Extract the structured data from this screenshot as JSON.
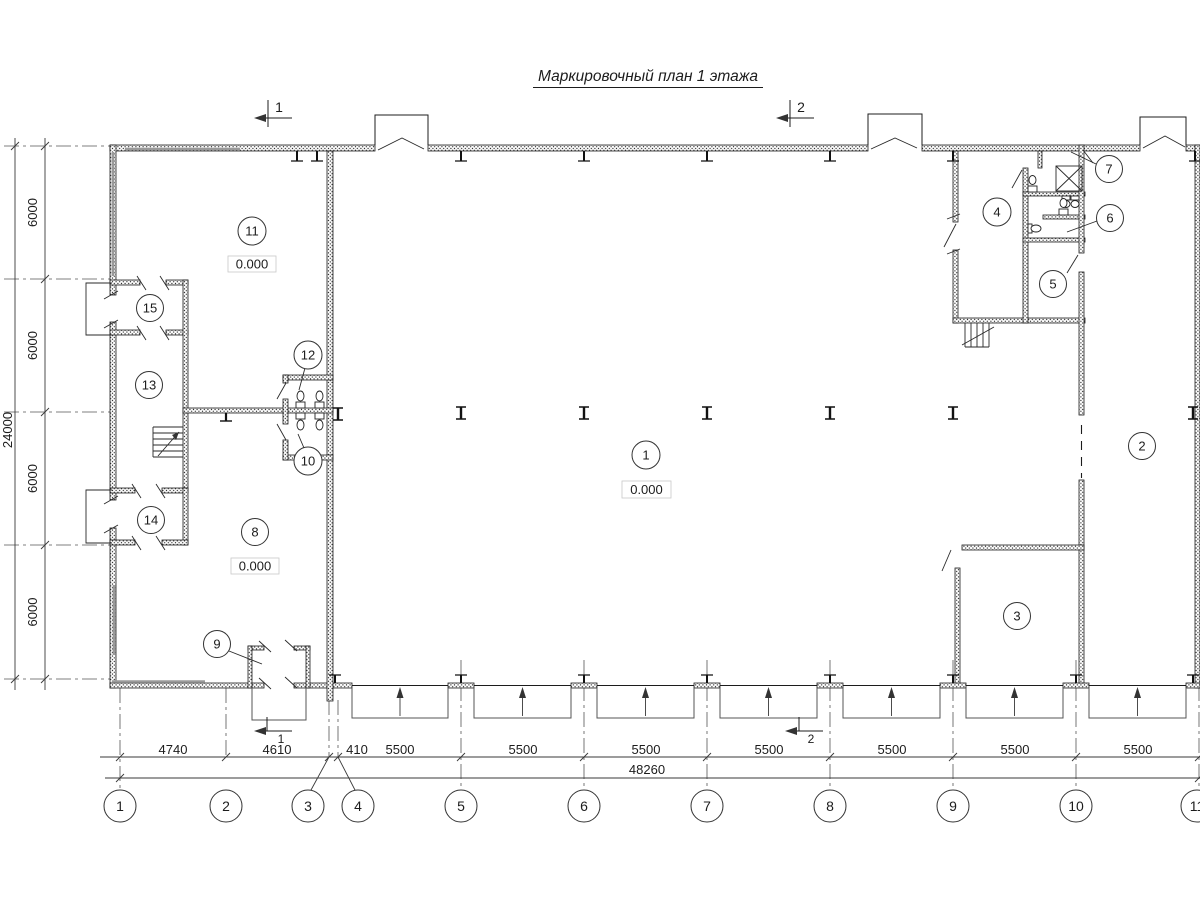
{
  "title": "Маркировочный план 1 этажа",
  "rooms": {
    "r1": "1",
    "r2": "2",
    "r3": "3",
    "r4": "4",
    "r5": "5",
    "r6": "6",
    "r7": "7",
    "r8": "8",
    "r9": "9",
    "r10": "10",
    "r11": "11",
    "r12": "12",
    "r13": "13",
    "r14": "14",
    "r15": "15"
  },
  "elevations": {
    "hall": "0.000",
    "room11": "0.000",
    "room8": "0.000"
  },
  "sections": {
    "s1": "1",
    "s2": "2"
  },
  "axes_bottom": [
    "1",
    "2",
    "3",
    "4",
    "5",
    "6",
    "7",
    "8",
    "9",
    "10",
    "11"
  ],
  "dims": {
    "bottom": [
      "4740",
      "4610",
      "410",
      "5500",
      "5500",
      "5500",
      "5500",
      "5500",
      "5500",
      "5500"
    ],
    "bottom_total": "48260",
    "left": [
      "6000",
      "6000",
      "6000",
      "6000"
    ],
    "left_total": "24000"
  },
  "colors": {
    "line": "#1c1c1c",
    "dim": "#3a3a3a",
    "window": "#9a9a9a"
  }
}
